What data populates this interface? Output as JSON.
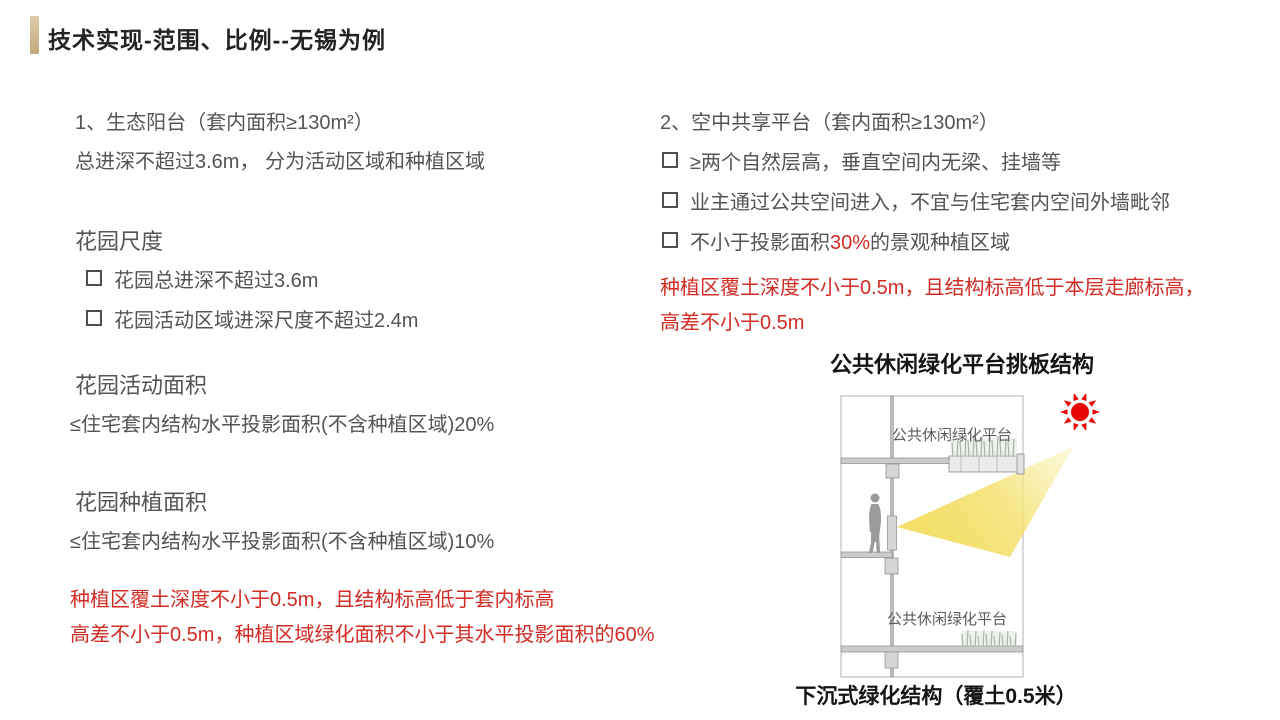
{
  "title": "技术实现-范围、比例--无锡为例",
  "colors": {
    "accent": "#c2a97c",
    "heading": "#222222",
    "body": "#545454",
    "red": "#d22b25",
    "sun": "#e60500",
    "beam": "#f3e06e"
  },
  "left": {
    "heading": "1、生态阳台（套内面积≥130m²）",
    "intro": "总进深不超过3.6m， 分为活动区域和种植区域",
    "scale_title": "花园尺度",
    "scale_items": [
      "花园总进深不超过3.6m",
      "花园活动区域进深尺度不超过2.4m"
    ],
    "activity_title": "花园活动面积",
    "activity_body": "≤住宅套内结构水平投影面积(不含种植区域)20%",
    "planting_title": "花园种植面积",
    "planting_body": "≤住宅套内结构水平投影面积(不含种植区域)10%",
    "note1": "种植区覆土深度不小于0.5m，且结构标高低于套内标高",
    "note2": "高差不小于0.5m，种植区域绿化面积不小于其水平投影面积的60%"
  },
  "right": {
    "heading": "2、空中共享平台（套内面积≥130m²）",
    "items": [
      "≥两个自然层高，垂直空间内无梁、挂墙等",
      "业主通过公共空间进入，不宜与住宅套内空间外墙毗邻"
    ],
    "item3": {
      "prefix": "不小于投影面积",
      "highlight": "30%",
      "suffix": "的景观种植区域"
    },
    "note1": "种植区覆土深度不小于0.5m，且结构标高低于本层走廊标高，",
    "note2": "高差不小于0.5m"
  },
  "diagram": {
    "title": "公共休闲绿化平台挑板结构",
    "label_top": "公共休闲绿化平台",
    "label_bottom": "公共休闲绿化平台",
    "caption": "下沉式绿化结构（覆土0.5米）"
  }
}
